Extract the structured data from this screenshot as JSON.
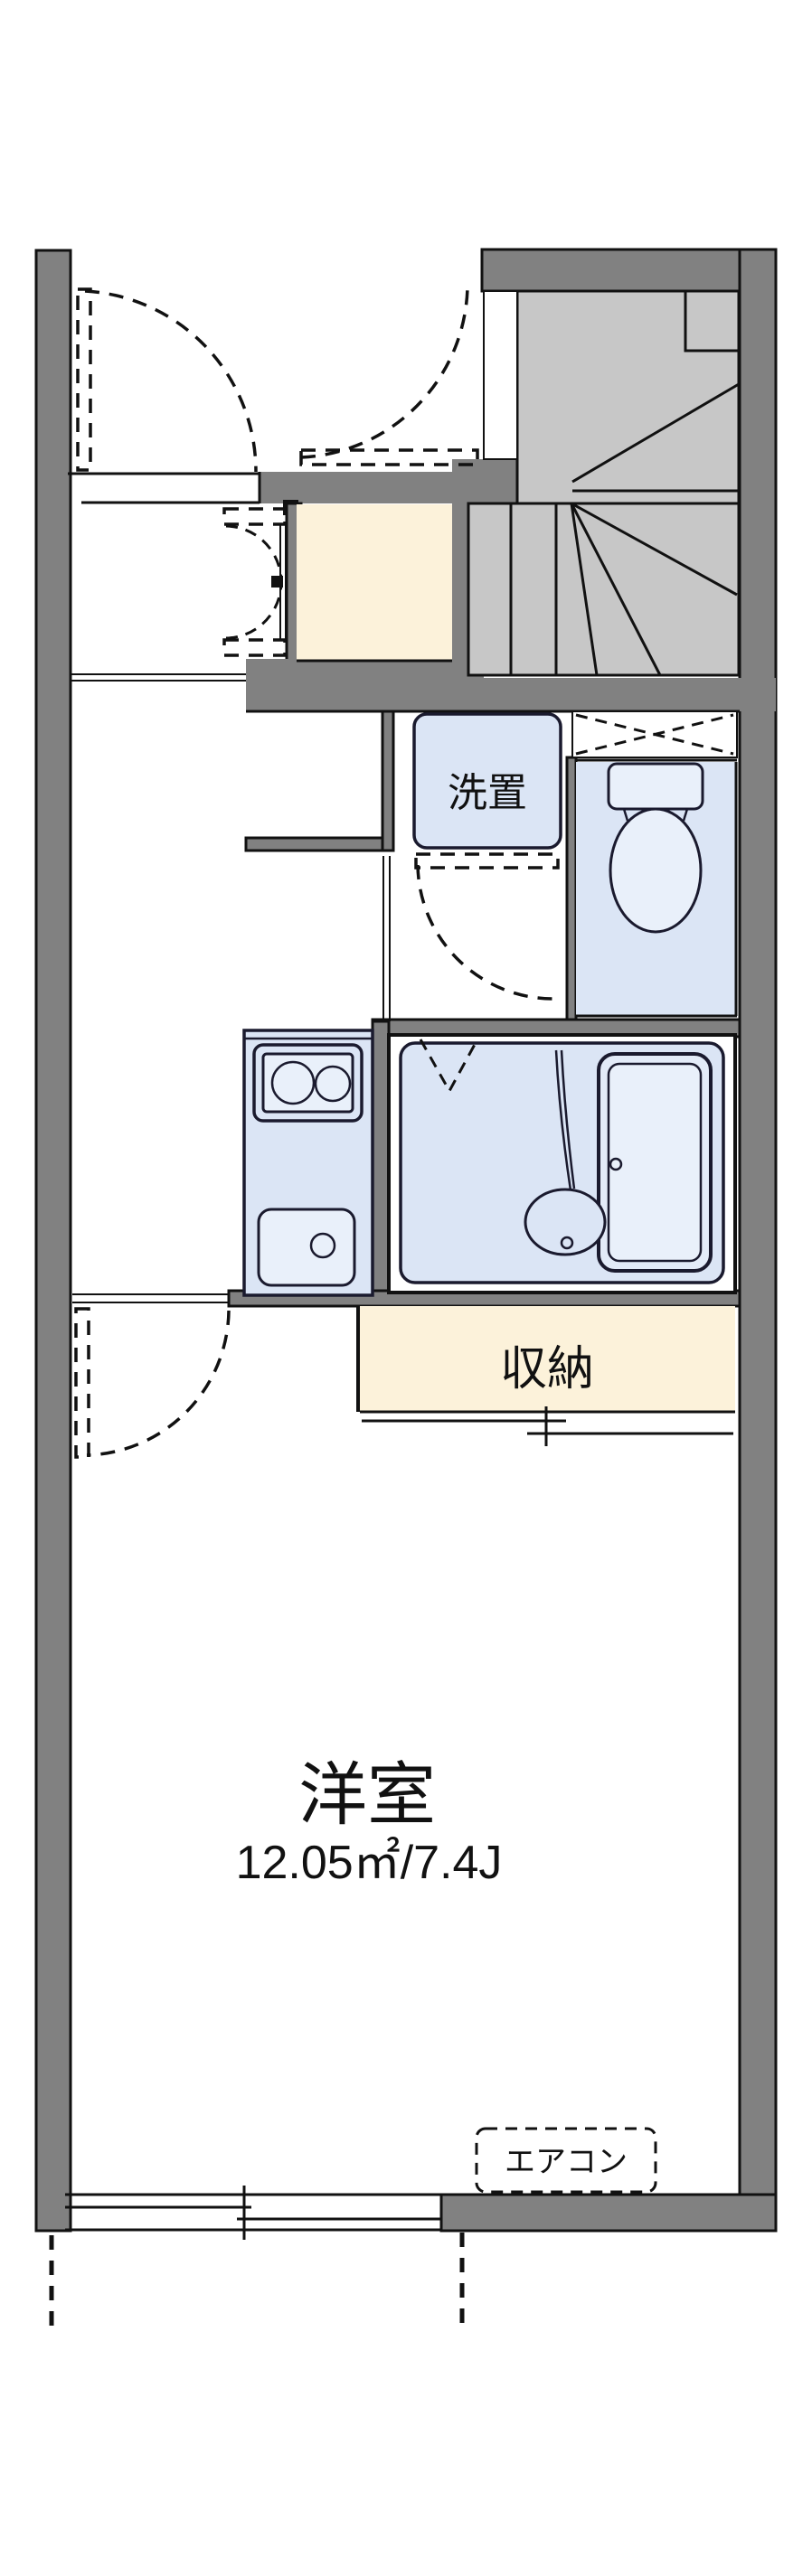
{
  "floorplan": {
    "type": "japanese-apartment-floor-plan",
    "labels": {
      "washer_storage": "洗置",
      "closet": "収納",
      "main_room_name": "洋室",
      "main_room_area": "12.05㎡/7.4J",
      "aircon": "エアコン"
    },
    "rooms": [
      {
        "name": "洋室",
        "area": "12.05㎡/7.4J"
      },
      {
        "name": "収納"
      },
      {
        "name": "洗置"
      }
    ],
    "colors": {
      "wall_gray": "#818181",
      "stair_gray": "#c7c7c7",
      "fixture_blue": "#dbe5f5",
      "fixture_blue_light": "#e9f0fa",
      "floor_cream": "#fcf2da",
      "line_black": "#111111",
      "fixture_line_navy": "#1a1a2e"
    }
  }
}
